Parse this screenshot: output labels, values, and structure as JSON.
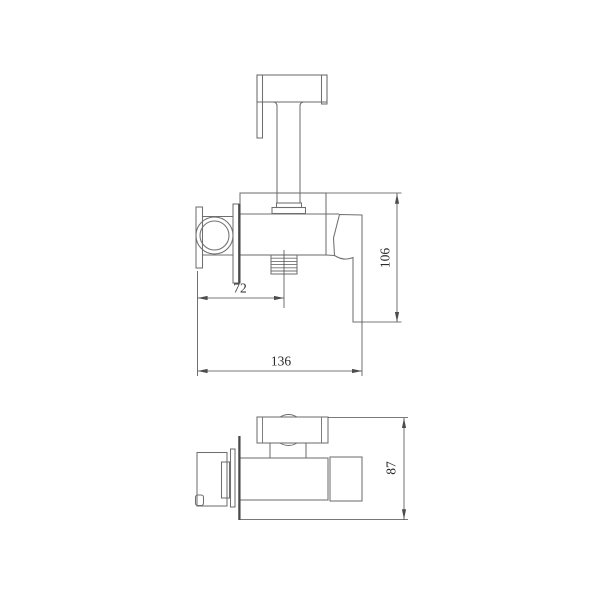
{
  "drawing": {
    "kind": "technical-orthographic-drawing",
    "subject": "wall-mounted bidet sprayer mixer valve",
    "views": [
      "side-view",
      "top-view"
    ]
  },
  "dimensions": {
    "outlet_offset": "72",
    "overall_length": "136",
    "height": "106",
    "depth": "87"
  },
  "colors": {
    "background": "#ffffff",
    "line": "#6f6f6f",
    "dim_line": "#4c4c4c",
    "wall_line": "#4a4a4a",
    "text": "#2b2b2b"
  }
}
